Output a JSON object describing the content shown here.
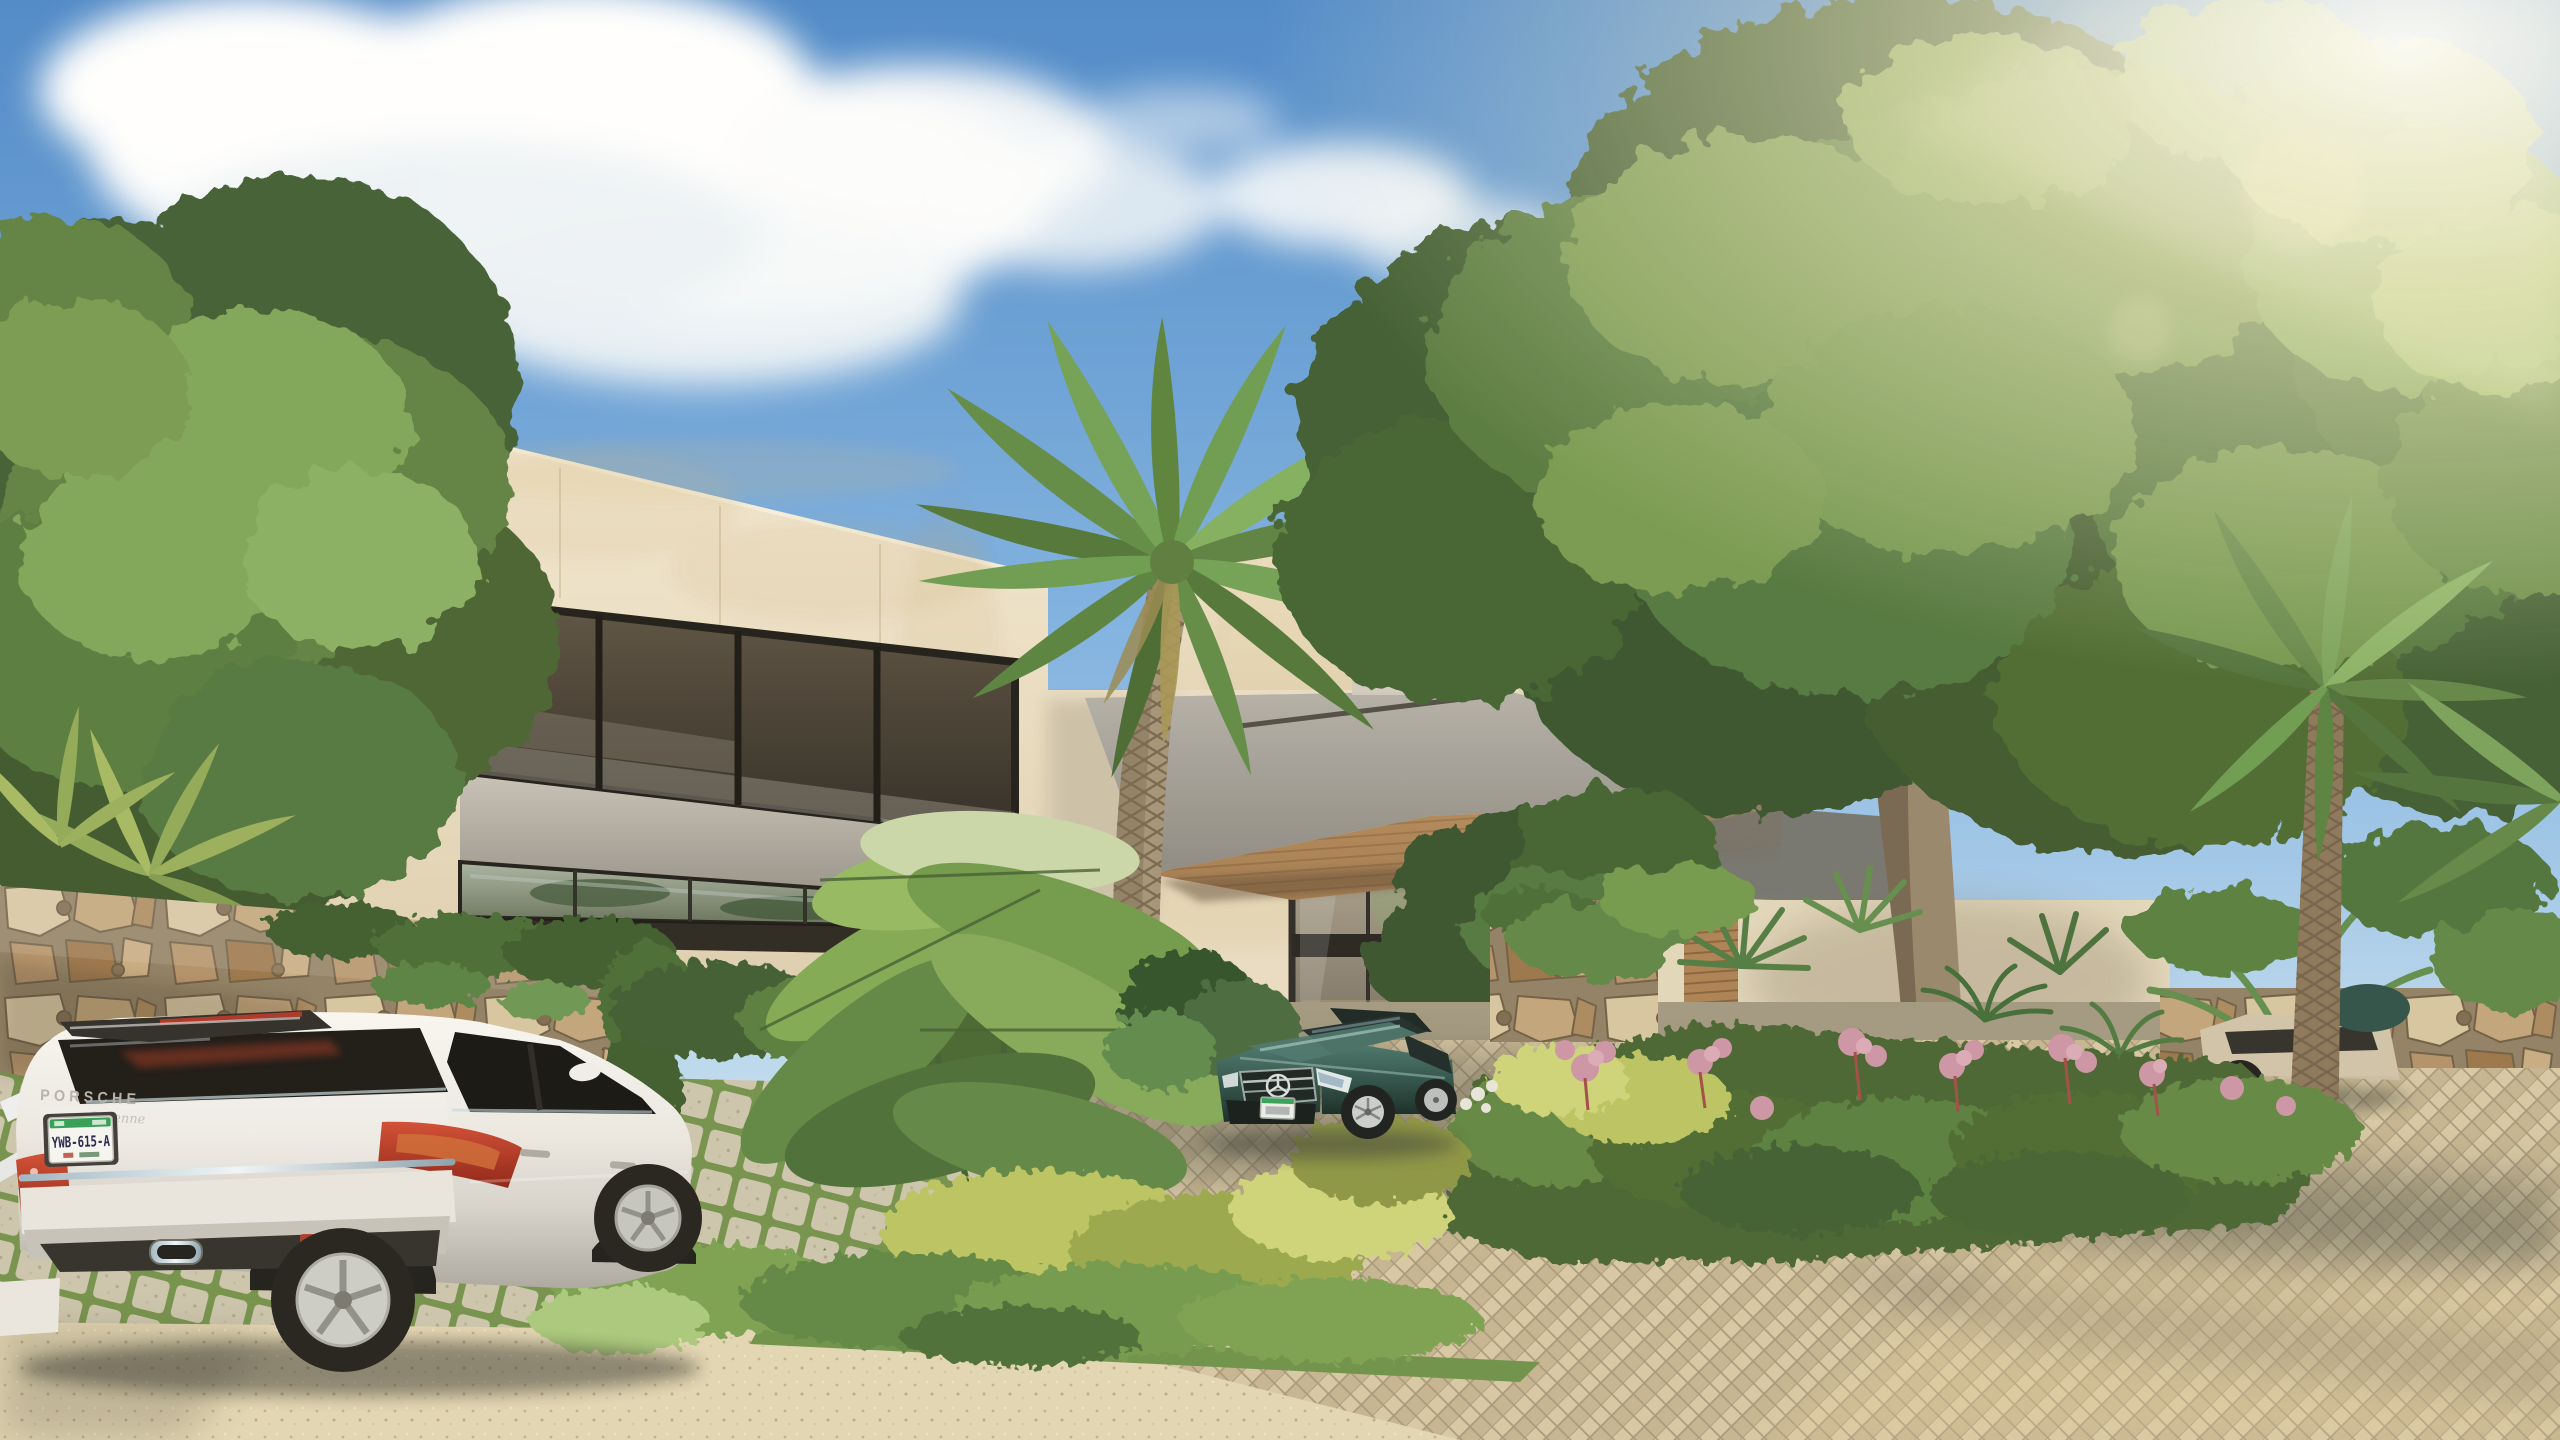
{
  "texts": {
    "porsche_wordmark": "PORSCHE",
    "porsche_model": "Cayenne",
    "license_plate": "YWB-615-A"
  },
  "palette": {
    "sky_top": "#4a87c8",
    "sky_horizon": "#ddecf6",
    "cloud_white": "#ffffff",
    "sun_glare": "#fff4d4",
    "limestone_light": "#f2e9d4",
    "limestone_shadow": "#d9caa9",
    "stain_ochre": "#c8a96c",
    "window_bronze": "#2c2720",
    "spandrel_grey": "#a6a199",
    "canopy_grey": "#98948c",
    "soffit_wood": "#a87c4e",
    "door_glass": "#8a8274",
    "stone_tan": "#c0a378",
    "stone_rust": "#9a7348",
    "mortar": "#8f7e61",
    "ivy_green": "#3c5a2c",
    "foliage_dark": "#3f5c30",
    "foliage_mid": "#5d8040",
    "foliage_light": "#7da457",
    "sunlit_leaf": "#a3c06e",
    "palm_trunk": "#a39274",
    "oak_trunk": "#96846a",
    "flower_pink": "#cb93a4",
    "chartreuse": "#b9c25e",
    "turf_grass": "#79a04c",
    "paver_block": "#e7e0c6",
    "brick_paver": "#d2c39e",
    "gravel": "#e2d5b2",
    "shadow_cool": "#3a3f38",
    "porsche_white": "#f2f0ea",
    "taillight_red": "#c7402c",
    "plate_green": "#2f9e52",
    "mercedes_teal": "#2e554c",
    "suv_champagne": "#cfc2a8"
  },
  "objects": {
    "vehicles": [
      "white Porsche Cayenne SUV parked on turf pavers",
      "dark teal Mercedes sedan at entry court",
      "champagne SUV behind right palm"
    ],
    "architecture": [
      "modern cream limestone residence",
      "bronze tinted window bands",
      "grey cantilevered entry canopy with wood soffit",
      "glass entry door",
      "carved stone relief panel",
      "dry stacked stone garden walls"
    ],
    "landscape": [
      "tall date palm",
      "large spreading tree",
      "flower island with pink blooms",
      "banana plants",
      "herringbone brick driveway",
      "beige gravel forecourt",
      "ivy on stone wall"
    ],
    "sky": [
      "blue sky",
      "cumulus clouds",
      "sun glare upper right"
    ]
  }
}
